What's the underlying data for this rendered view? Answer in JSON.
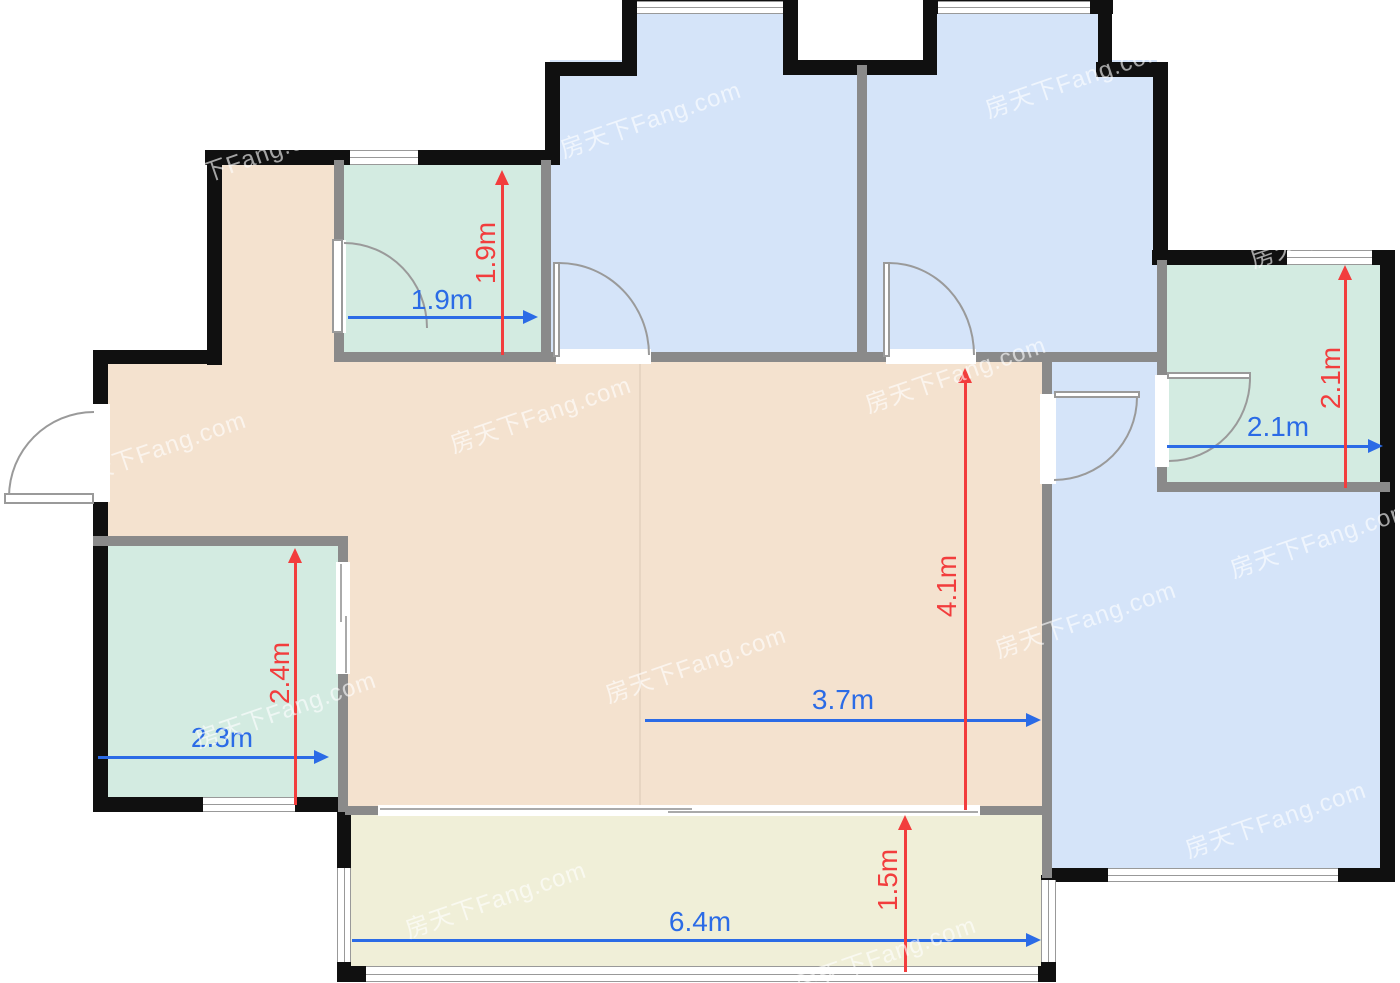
{
  "plan": {
    "watermark_text": "房天下Fang.com",
    "colors": {
      "bedroom_fill": "#d5e4f9",
      "bath_fill": "#d3ebe1",
      "living_fill": "#f4e2cf",
      "balcony_fill": "#f0efd8",
      "outer_wall": "#101010",
      "inner_wall": "#8a8a8a",
      "dim_blue": "#2b6be6",
      "dim_red": "#f23d3d"
    },
    "rooms": {
      "bath_top": {
        "width_label": "1.9m",
        "height_label": "1.9m"
      },
      "bath_right": {
        "width_label": "2.1m",
        "height_label": "2.1m"
      },
      "living": {
        "width_label": "3.7m",
        "height_label": "4.1m"
      },
      "kitchen": {
        "width_label": "2.3m",
        "height_label": "2.4m"
      },
      "balcony": {
        "width_label": "6.4m",
        "height_label": "1.5m"
      }
    }
  }
}
